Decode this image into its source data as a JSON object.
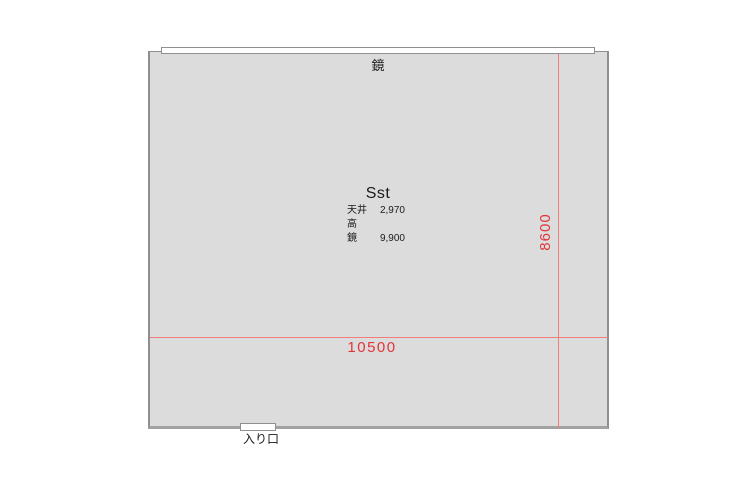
{
  "floor_plan": {
    "room": {
      "name": "Sst",
      "mirror_label": "鏡",
      "entrance_label": "入り口",
      "specs": [
        {
          "label": "天井高",
          "value": "2,970"
        },
        {
          "label": "鏡",
          "value": "9,900"
        }
      ]
    },
    "dimensions": {
      "width_mm": "10500",
      "height_mm": "8600"
    },
    "colors": {
      "room_fill": "#dcdcdc",
      "wall_stroke": "#8f8f8f",
      "dimension_line": "#f27d7d",
      "dimension_text": "#e0353a",
      "label_text": "#1a1a1a"
    }
  }
}
